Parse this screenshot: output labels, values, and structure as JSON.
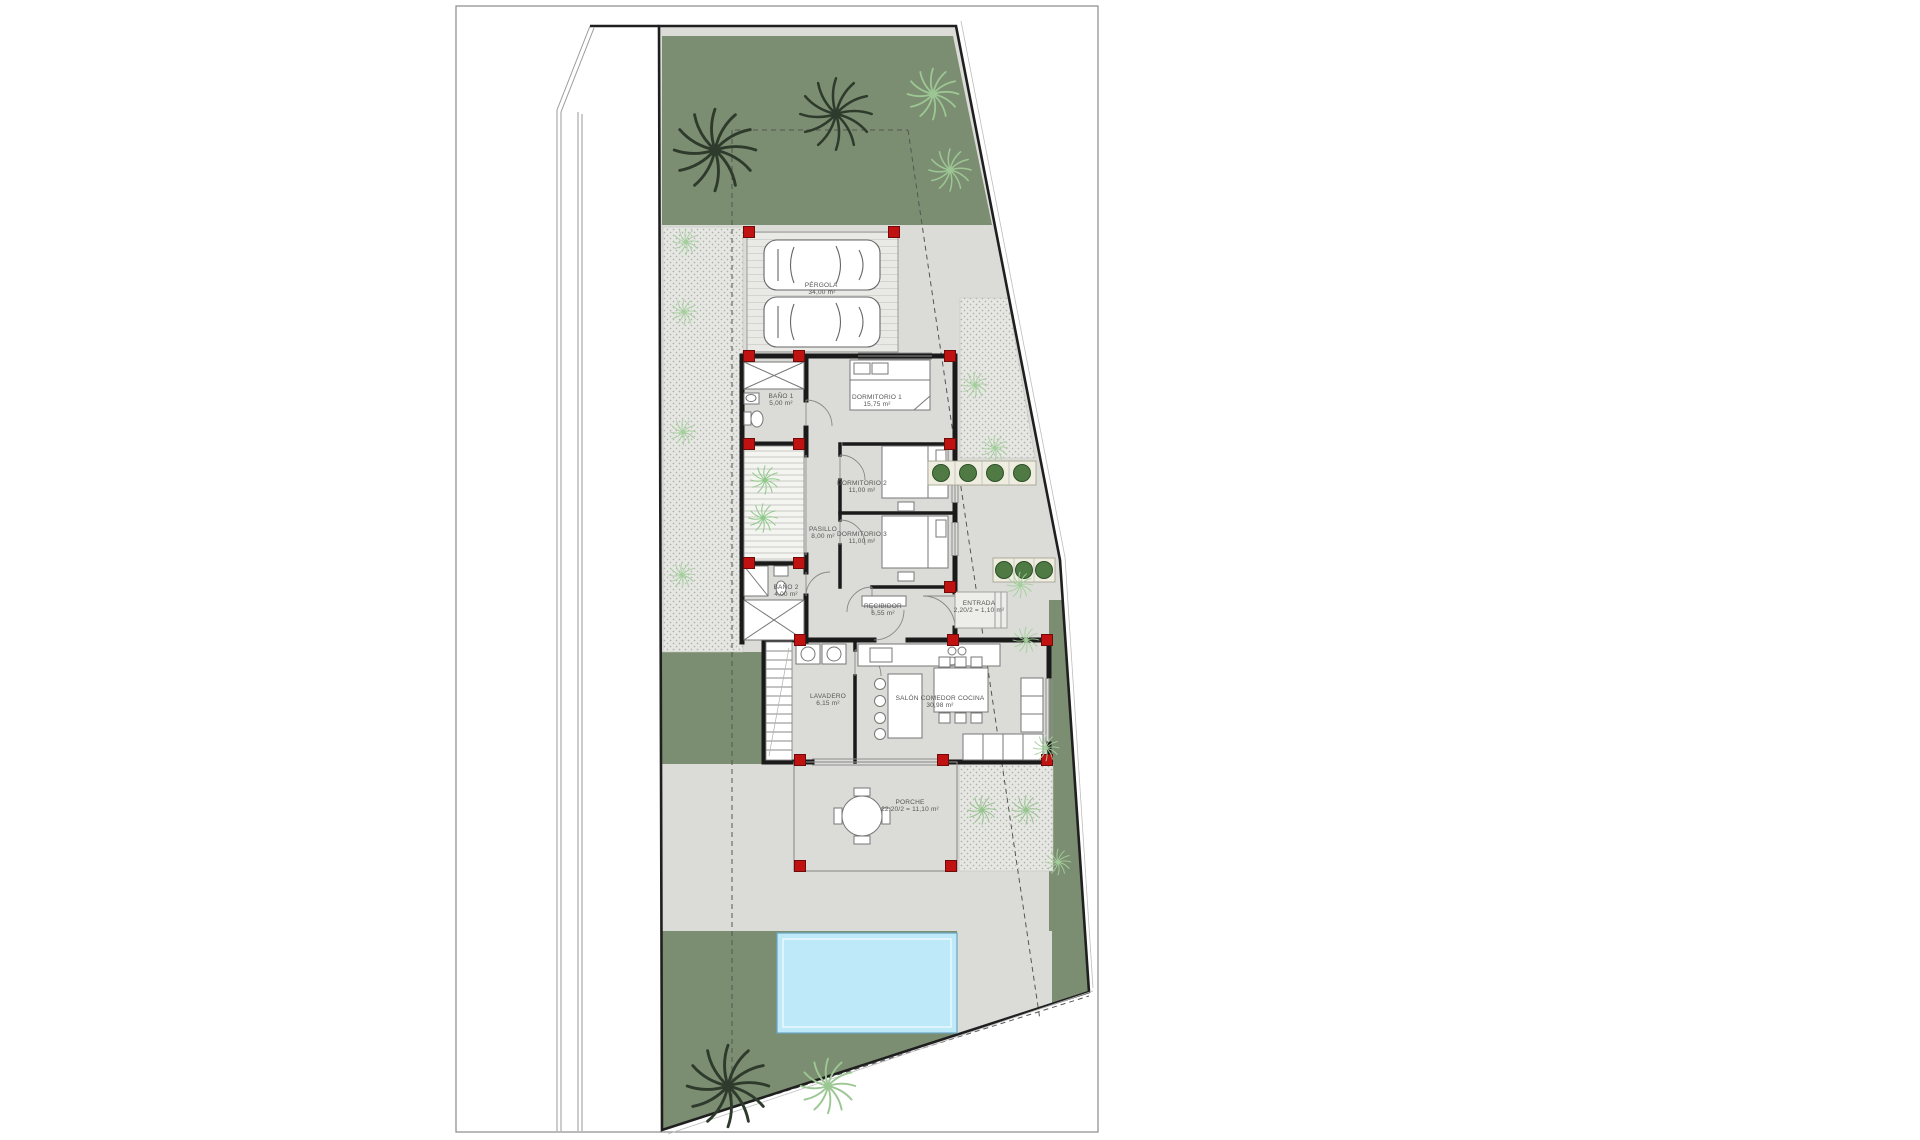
{
  "plan": {
    "rooms": [
      {
        "name": "PÉRGOLA",
        "area": "34,00 m²"
      },
      {
        "name": "BAÑO 1",
        "area": "5,00 m²"
      },
      {
        "name": "DORMITORIO 1",
        "area": "15,75 m²"
      },
      {
        "name": "DORMITORIO 2",
        "area": "11,00 m²"
      },
      {
        "name": "PASILLO",
        "area": "8,00 m²"
      },
      {
        "name": "DORMITORIO 3",
        "area": "11,00 m²"
      },
      {
        "name": "BAÑO 2",
        "area": "4,00 m²"
      },
      {
        "name": "RECIBIDOR",
        "area": "6,55 m²"
      },
      {
        "name": "ENTRADA",
        "area": "2,20/2 = 1,10 m²"
      },
      {
        "name": "LAVADERO",
        "area": "6,15 m²"
      },
      {
        "name": "SALÓN COMEDOR COCINA",
        "area": "30,98 m²"
      },
      {
        "name": "PORCHE",
        "area": "22,20/2 = 11,10 m²"
      }
    ],
    "colors": {
      "grass": "#7c8e71",
      "paving": "#dbdcd8",
      "paving_dotted": "#e6e7e3",
      "pool_fill": "#bee9f9",
      "pool_edge": "#69a7c2",
      "column_red": "#c11212",
      "wall": "#1a1a1a",
      "tree_dark": "#2e3a2c",
      "tree_light": "#9cc794",
      "shrub": "#a4cf9c"
    },
    "site": {
      "cars_in_pergola": 2,
      "swimming_pool": 1,
      "planter_rows": 2
    }
  }
}
